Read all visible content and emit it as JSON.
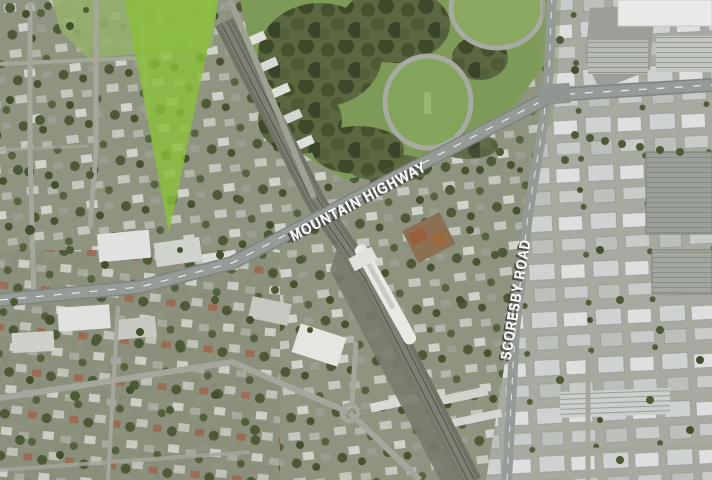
{
  "map": {
    "kind": "aerial-satellite-photo",
    "road_labels": {
      "primary": "MOUNTAIN HIGHWAY",
      "secondary": "SCORESBY ROAD"
    },
    "label_style": {
      "text_color": "#ffffff",
      "shadow_color": "#3e3f39"
    },
    "marker": {
      "shape": "wedge",
      "color": "#8ac02f",
      "fill_rgba": "rgba(138,192,55,0.8)"
    }
  }
}
